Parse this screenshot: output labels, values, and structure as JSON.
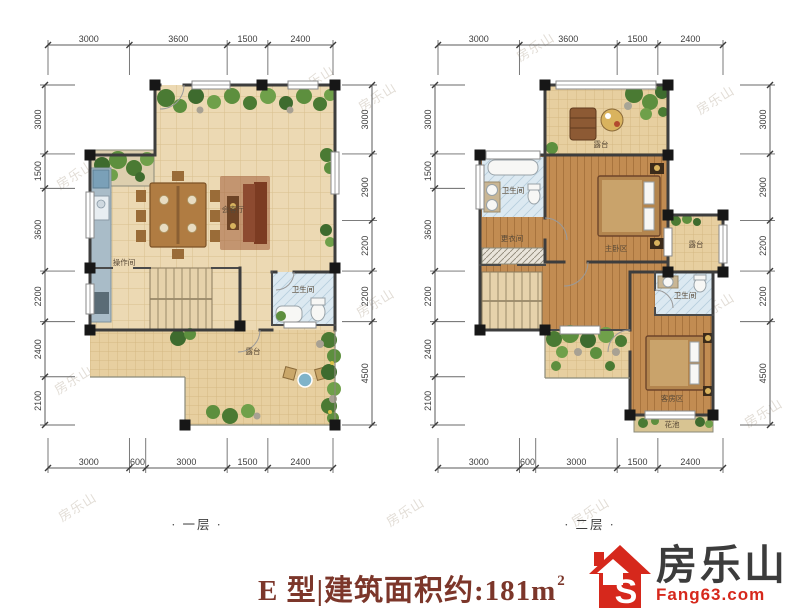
{
  "watermark": {
    "text": "房乐山"
  },
  "plans": [
    {
      "id": "floor-1",
      "caption": "· 一层 ·",
      "dims": {
        "top": {
          "y": 45,
          "x0": 48,
          "x1": 333,
          "tick": 1,
          "values": [
            "3000",
            "3600",
            "1500",
            "2400"
          ]
        },
        "bottom": {
          "y": 468,
          "x0": 48,
          "x1": 333,
          "tick": -1,
          "values": [
            "3000",
            "600",
            "3000",
            "1500",
            "2400"
          ]
        },
        "left": {
          "x": 45,
          "y0": 85,
          "y1": 425,
          "tick": 1,
          "values": [
            "3000",
            "1500",
            "3600",
            "2200",
            "2400",
            "2100"
          ]
        },
        "right": {
          "x": 372,
          "y0": 85,
          "y1": 425,
          "tick": -1,
          "values": [
            "3000",
            "2900",
            "2200",
            "2200",
            "4500"
          ]
        }
      },
      "labels": [
        {
          "text": "会客厅",
          "x": 233,
          "y": 212
        },
        {
          "text": "操作间",
          "x": 124,
          "y": 265
        },
        {
          "text": "卫生间",
          "x": 303,
          "y": 292
        },
        {
          "text": "露台",
          "x": 253,
          "y": 354
        }
      ]
    },
    {
      "id": "floor-2",
      "caption": "· 二层 ·",
      "dims": {
        "top": {
          "y": 45,
          "x0": 438,
          "x1": 723,
          "tick": 1,
          "values": [
            "3000",
            "3600",
            "1500",
            "2400"
          ]
        },
        "bottom": {
          "y": 468,
          "x0": 438,
          "x1": 723,
          "tick": -1,
          "values": [
            "3000",
            "600",
            "3000",
            "1500",
            "2400"
          ]
        },
        "left": {
          "x": 435,
          "y0": 85,
          "y1": 425,
          "tick": 1,
          "values": [
            "3000",
            "1500",
            "3600",
            "2200",
            "2400",
            "2100"
          ]
        },
        "right": {
          "x": 770,
          "y0": 85,
          "y1": 425,
          "tick": -1,
          "values": [
            "3000",
            "2900",
            "2200",
            "2200",
            "4500"
          ]
        }
      },
      "labels": [
        {
          "text": "露台",
          "x": 601,
          "y": 147
        },
        {
          "text": "卫生间",
          "x": 513,
          "y": 193
        },
        {
          "text": "更衣间",
          "x": 512,
          "y": 241
        },
        {
          "text": "主卧区",
          "x": 616,
          "y": 251
        },
        {
          "text": "露台",
          "x": 696,
          "y": 247
        },
        {
          "text": "卫生间",
          "x": 685,
          "y": 298
        },
        {
          "text": "客房区",
          "x": 672,
          "y": 401
        },
        {
          "text": "花池",
          "x": 672,
          "y": 427
        }
      ]
    }
  ],
  "footer": {
    "title": "E 型|建筑面积约:181m",
    "title_sup": "2",
    "logo_name": "房乐山",
    "logo_domain": "Fang63.com",
    "logo_icon_letter": "S"
  }
}
